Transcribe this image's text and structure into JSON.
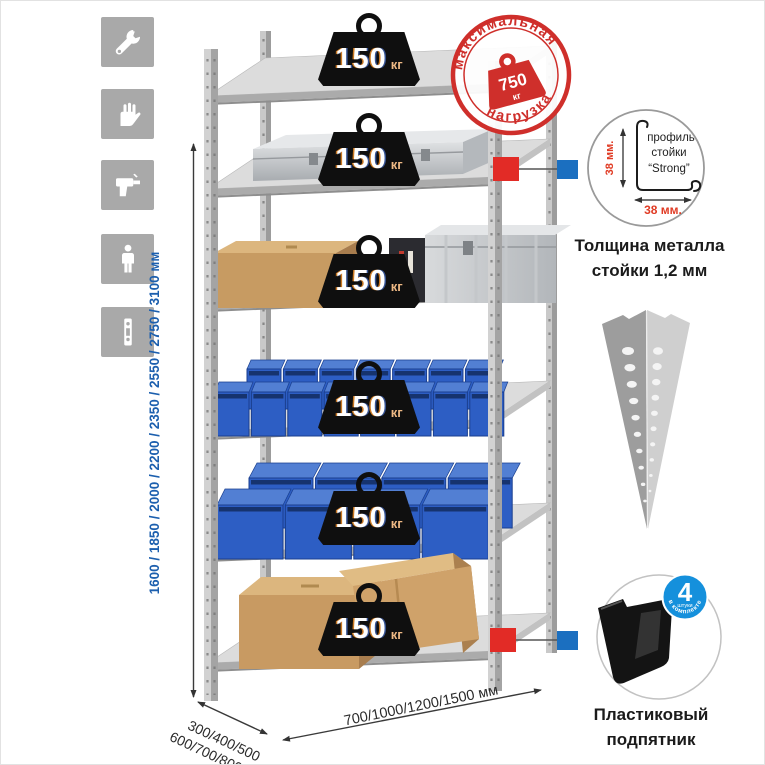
{
  "icons": [
    "wrench-icon",
    "gloves-icon",
    "drill-icon",
    "person-icon",
    "rack-post-icon"
  ],
  "rack": {
    "shelf_count": 6,
    "shelf_load": {
      "value": "150",
      "unit": "кг"
    }
  },
  "max_load_stamp": {
    "arc_top": "максимальная",
    "arc_bottom": "нагрузка",
    "value": "750",
    "unit": "кг"
  },
  "dimensions": {
    "heights": "1600 / 1850 / 2000 / 2200 / 2350 / 2550 / 2750 / 3100 мм",
    "depth_line1": "300/400/500",
    "depth_line2": "600/700/800 мм",
    "width": "700/1000/1200/1500 мм"
  },
  "profile_detail": {
    "line1": "профиль",
    "line2": "стойки",
    "line3": "“Strong”",
    "vertical_dim": "38 мм.",
    "horizontal_dim": "38 мм.",
    "caption_line1": "Толщина металла",
    "caption_line2": "стойки 1,2 мм"
  },
  "foot_detail": {
    "badge_number": "4",
    "badge_sub": "штуки",
    "badge_arc": "в комплекте",
    "caption_line1": "Пластиковый",
    "caption_line2": "подпятник"
  },
  "colors": {
    "accent_red": "#cf2f2b",
    "accent_blue": "#1b6fc0",
    "dim_text_blue": "#1c5fae",
    "bin_blue": "#2d5ec4",
    "cardboard": "#c89a62",
    "metal_gray": "#c3c3c3"
  }
}
